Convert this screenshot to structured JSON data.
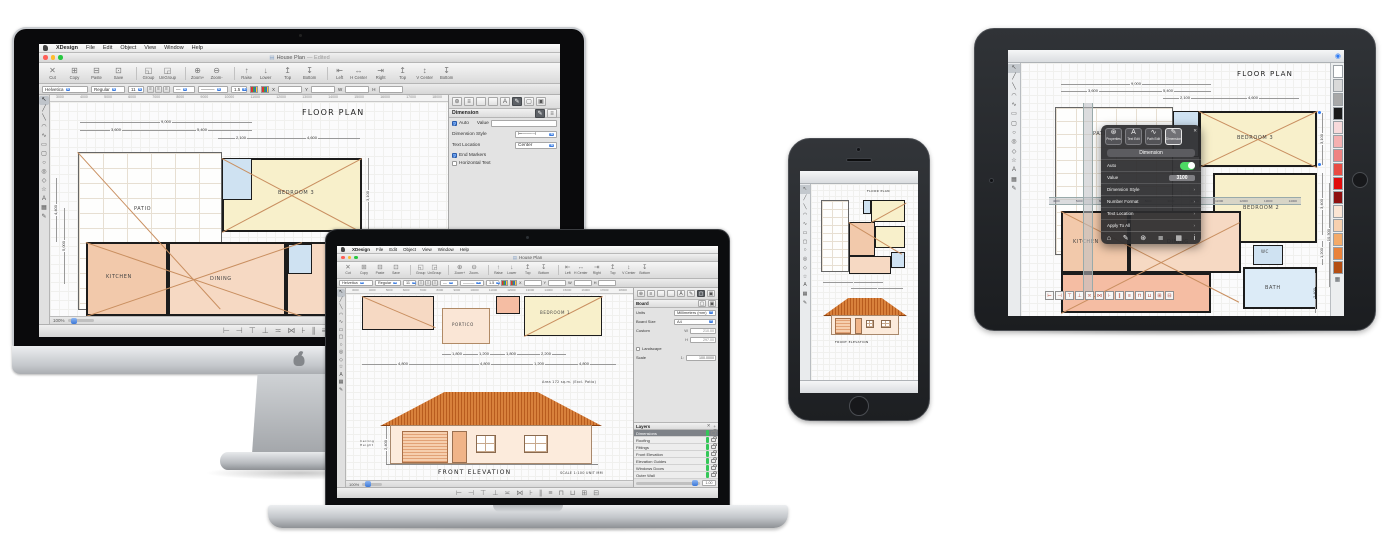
{
  "menu": {
    "items": [
      "XDesign",
      "File",
      "Edit",
      "Object",
      "View",
      "Window",
      "Help"
    ]
  },
  "mac": {
    "toolbar": [
      {
        "icon": "✕",
        "label": "Cut"
      },
      {
        "icon": "⊞",
        "label": "Copy"
      },
      {
        "icon": "⊟",
        "label": "Paste"
      },
      {
        "icon": "⊡",
        "label": "Save"
      },
      {
        "icon": "◱",
        "label": "Group",
        "group": true
      },
      {
        "icon": "◲",
        "label": "UnGroup"
      },
      {
        "icon": "⊕",
        "label": "Zoom+",
        "group": true
      },
      {
        "icon": "⊖",
        "label": "Zoom-"
      },
      {
        "icon": "↑",
        "label": "Raise",
        "group": true,
        "accent": true
      },
      {
        "icon": "↓",
        "label": "Lower",
        "accent": true
      },
      {
        "icon": "↥",
        "label": "Top",
        "accent": true
      },
      {
        "icon": "↧",
        "label": "Bottom",
        "accent": true
      },
      {
        "icon": "⇤",
        "label": "Left",
        "group": true
      },
      {
        "icon": "↔",
        "label": "H Center"
      },
      {
        "icon": "⇥",
        "label": "Right"
      },
      {
        "icon": "↥",
        "label": "Top"
      },
      {
        "icon": "↕",
        "label": "V Center"
      },
      {
        "icon": "↧",
        "label": "Bottom"
      }
    ],
    "format": {
      "font": "Helvetica",
      "style": "Regular",
      "size": "11",
      "justify": [
        "≡",
        "≡",
        "≡"
      ],
      "line1": "—",
      "line2": "———",
      "weight": "1.5",
      "stepper": "⇅",
      "x": "X",
      "y": "Y",
      "w": "W",
      "h": "H"
    },
    "ruler": [
      "3000",
      "4000",
      "5000",
      "6000",
      "7000",
      "8000",
      "9000",
      "10000",
      "11000",
      "12000",
      "13000",
      "14000",
      "15000",
      "16000",
      "17000",
      "18000"
    ],
    "align_icons": [
      "⊢",
      "⊣",
      "⊤",
      "⊥",
      "≍",
      "⋈",
      "⊦",
      "∥",
      "≡",
      "⊓",
      "⊔",
      "⊞",
      "⊟"
    ]
  },
  "shared": {
    "tools": [
      "↖",
      "╱",
      "╲",
      "◠",
      "∿",
      "▭",
      "▢",
      "○",
      "◎",
      "◇",
      "☆",
      "A",
      "▦",
      "✎"
    ]
  },
  "imac": {
    "window_title": "House Plan",
    "window_title_suffix": "— Edited",
    "doc_icon": "▤",
    "canvas": {
      "title": "FLOOR PLAN",
      "dims": [
        "9,000",
        "3,600",
        "5,400",
        "2,100",
        "4,600"
      ],
      "dim_right": "3,100",
      "dims_left": [
        "4,400",
        "5,000"
      ],
      "rooms": {
        "patio": "PATIO",
        "bedroom3": "BEDROOM 3",
        "kitchen": "KITCHEN",
        "dining": "DINING"
      }
    },
    "panel": {
      "gear_icon": "⊛",
      "list_icon": "≡",
      "text_icon": "A",
      "pen_icon": "✎",
      "shape_icon": "▢",
      "board_icon": "▣",
      "section": "Dimension",
      "auto": "Auto",
      "value_label": "Value",
      "style_label": "Dimension Style",
      "style_preview": "⊢——⊣",
      "location_label": "Text Location",
      "location_value": "Center",
      "end_markers": "End Markers",
      "horizontal_text": "Horizontal Text",
      "layers_title": "Layers",
      "delete_icon": "✕",
      "add_icon": "+",
      "layer_selected": "Dimensions"
    },
    "status_zoom": "100%"
  },
  "macbook": {
    "window_title": "House Plan",
    "canvas": {
      "rooms": {
        "portico": "PORTICO",
        "bedroom1": "BEDROOM 1"
      },
      "dims_upper": [
        "1,800",
        "1,200",
        "1,800",
        "2,200"
      ],
      "dims_lower": [
        "4,800",
        "4,800",
        "1,200",
        "4,800"
      ],
      "area_note": "Area 172 sq.m.  (Excl. Patio)",
      "elevation_title": "FRONT ELEVATION",
      "scale_note": "SCALE 1:100   UNIT MM",
      "ceiling_dim": "2,400",
      "ceiling_label": "Ceiling Height"
    },
    "panel": {
      "section": "Board",
      "shape_icon": "▢",
      "board_icon": "▣",
      "units_label": "Units",
      "units_value": "Millimeters (mm)",
      "size_label": "Board Size",
      "size_value": "A4",
      "custom_label": "Custom",
      "w_label": "W",
      "w_value": "210.00",
      "h_label": "H",
      "h_value": "297.00",
      "landscape": "Landscape",
      "scale_label": "Scale",
      "scale_prefix": "1:",
      "scale_value": "100.0000",
      "layers_title": "Layers",
      "delete_icon": "✕",
      "add_icon": "+",
      "layers": [
        {
          "name": "Dimensions",
          "selected": true
        },
        {
          "name": "Roofing"
        },
        {
          "name": "Fittings"
        },
        {
          "name": "Front Elevation"
        },
        {
          "name": "Elevation Guides"
        },
        {
          "name": "Windows Doors"
        },
        {
          "name": "Outer Wall"
        }
      ],
      "opacity": "1.00"
    },
    "status_zoom": "100%"
  },
  "iphone": {
    "top_icons": [
      {
        "icon": "▤"
      },
      {
        "icon": "+"
      },
      {
        "icon": "↶"
      },
      {
        "icon": "⊕"
      },
      {
        "icon": "⊖"
      },
      {
        "icon": "⊜"
      },
      {
        "icon": "⊙"
      },
      {
        "icon": "⊡"
      },
      {
        "icon": "◉",
        "accent": true
      }
    ],
    "bottom_icons": [
      {
        "icon": "+"
      },
      {
        "icon": "◎"
      },
      {
        "icon": "↷"
      },
      {
        "icon": "⊞"
      },
      {
        "icon": "○"
      },
      {
        "icon": "▢"
      },
      {
        "icon": "⇆",
        "accent": true
      },
      {
        "icon": "⇅",
        "accent": true
      },
      {
        "icon": "✎"
      },
      {
        "icon": "▦"
      }
    ],
    "canvas": {
      "title": "FLOOR PLAN",
      "elevation_title": "FRONT ELEVATION"
    }
  },
  "ipad": {
    "top_icons": [
      {
        "icon": "▤"
      },
      {
        "icon": "+"
      },
      {
        "icon": "✕"
      },
      {
        "icon": "⊞"
      },
      {
        "icon": "⊟"
      },
      {
        "icon": "↶",
        "dim": true
      },
      {
        "icon": "↷",
        "dim": true
      },
      {
        "icon": "⊕"
      },
      {
        "icon": "⊖"
      },
      {
        "icon": "⊜"
      },
      {
        "icon": "⊙"
      },
      {
        "icon": "⊡"
      }
    ],
    "compass_icon": "◉",
    "ruler": [
      "4000",
      "5000",
      "6000",
      "7000",
      "8000",
      "9000",
      "10000",
      "11000",
      "12000",
      "13000",
      "14000"
    ],
    "canvas": {
      "title": "FLOOR PLAN",
      "dims": [
        "9,000",
        "3,600",
        "5,400",
        "2,100",
        "4,600"
      ],
      "dims_right": [
        "3,100",
        "3,400",
        "1,200",
        "10,300",
        "2,400"
      ],
      "rooms": {
        "patio": "PATIO",
        "bedroom3": "BEDROOM 3",
        "bedroom2": "BEDROOM 2",
        "kitchen": "KITCHEN",
        "dining": "DINING",
        "wc": "WC",
        "bath": "BATH"
      }
    },
    "popup": {
      "tabs": [
        {
          "icon": "⊛",
          "label": "Properties"
        },
        {
          "icon": "A",
          "label": "Text Edit"
        },
        {
          "icon": "∿",
          "label": "Path Edit"
        },
        {
          "icon": "✎",
          "label": "Dimension",
          "selected": true
        }
      ],
      "close_icon": "✕",
      "title": "Dimension",
      "auto_label": "Auto",
      "value_label": "Value",
      "value": "3100",
      "rows": [
        {
          "label": "Dimension Style",
          "chevron": "›"
        },
        {
          "label": "Number Format",
          "chevron": "›"
        },
        {
          "label": "Text Location",
          "chevron": "›"
        },
        {
          "label": "Apply To All",
          "chevron": "›"
        }
      ],
      "bottom_icons": [
        "⌂",
        "✎",
        "⊛",
        "≣",
        "▦",
        "i"
      ]
    },
    "swatches": [
      "#ffffff",
      "#d9d9d9",
      "#a8a8a8",
      "#1b1b1b",
      "#f8dadb",
      "#f4b0b0",
      "#ef8383",
      "#e94c43",
      "#e10c0c",
      "#8f1010",
      "#fbe5d4",
      "#f7d0af",
      "#f3aa69",
      "#e9823b",
      "#b44e13"
    ]
  }
}
